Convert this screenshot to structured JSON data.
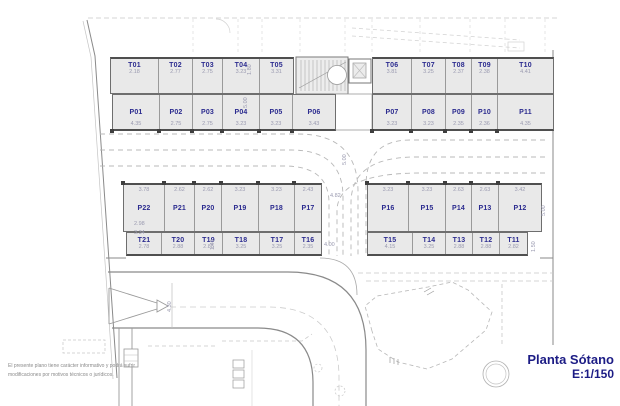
{
  "title_block": {
    "title": "Planta Sótano",
    "scale": "E:1/150"
  },
  "disclaimer": {
    "line1": "El presente plano tiene carácter informativo y podrá sufrir",
    "line2": "modificaciones por motivos técnicos o jurídicos."
  },
  "colors": {
    "label_blue": "#2b2b8f",
    "title_navy": "#1c1c85",
    "stall_fill": "#e9e9e9",
    "wall_gray": "#4f4f4f",
    "dim_gray": "#9a9ab0"
  },
  "plan": {
    "groups": [
      {
        "id": "storage-top-left",
        "type": "storage",
        "style": "t-top",
        "x": 110,
        "y": 57,
        "h": 37,
        "sq": "",
        "stalls": [
          {
            "label": "T01",
            "dim": "2.18",
            "w": 47
          },
          {
            "label": "T02",
            "dim": "2.77",
            "w": 34
          },
          {
            "label": "T03",
            "dim": "2.75",
            "w": 30
          },
          {
            "label": "T04",
            "dim": "3.23",
            "w": 37
          },
          {
            "label": "T05",
            "dim": "3.31",
            "w": 34
          }
        ]
      },
      {
        "id": "storage-top-right",
        "type": "storage",
        "style": "t-top",
        "x": 372,
        "y": 57,
        "h": 37,
        "sq": "",
        "stalls": [
          {
            "label": "T06",
            "dim": "3.81",
            "w": 38
          },
          {
            "label": "T07",
            "dim": "3.25",
            "w": 34
          },
          {
            "label": "T08",
            "dim": "2.37",
            "w": 26
          },
          {
            "label": "T09",
            "dim": "2.38",
            "w": 26
          },
          {
            "label": "T10",
            "dim": "4.41",
            "w": 56
          }
        ]
      },
      {
        "id": "parking-top-left",
        "type": "parking",
        "style": "p-mid",
        "x": 112,
        "y": 94,
        "h": 37,
        "sq": "bottom",
        "stalls": [
          {
            "label": "P01",
            "dim": "4.35",
            "w": 46
          },
          {
            "label": "P02",
            "dim": "2.75",
            "w": 33
          },
          {
            "label": "P03",
            "dim": "2.75",
            "w": 30
          },
          {
            "label": "P04",
            "dim": "3.23",
            "w": 37
          },
          {
            "label": "P05",
            "dim": "3.23",
            "w": 33
          },
          {
            "label": "P06",
            "dim": "3.43",
            "w": 43
          }
        ]
      },
      {
        "id": "parking-top-right",
        "type": "parking",
        "style": "p-mid",
        "x": 372,
        "y": 94,
        "h": 37,
        "sq": "bottom",
        "stalls": [
          {
            "label": "P07",
            "dim": "3.23",
            "w": 38
          },
          {
            "label": "P08",
            "dim": "3.23",
            "w": 34
          },
          {
            "label": "P09",
            "dim": "2.35",
            "w": 26
          },
          {
            "label": "P10",
            "dim": "2.36",
            "w": 26
          },
          {
            "label": "P11",
            "dim": "4.35",
            "w": 56
          }
        ]
      },
      {
        "id": "parking-mid-left",
        "type": "parking",
        "style": "p-dimtop",
        "x": 123,
        "y": 183,
        "h": 49,
        "sq": "top",
        "stalls": [
          {
            "label": "P22",
            "dim": "3.78",
            "w": 40
          },
          {
            "label": "P21",
            "dim": "2.62",
            "w": 30
          },
          {
            "label": "P20",
            "dim": "2.62",
            "w": 27
          },
          {
            "label": "P19",
            "dim": "3.23",
            "w": 37
          },
          {
            "label": "P18",
            "dim": "3.23",
            "w": 36
          },
          {
            "label": "P17",
            "dim": "2.43",
            "w": 27
          }
        ]
      },
      {
        "id": "parking-mid-right",
        "type": "parking",
        "style": "p-dimtop",
        "x": 367,
        "y": 183,
        "h": 49,
        "sq": "top",
        "stalls": [
          {
            "label": "P16",
            "dim": "3.23",
            "w": 40
          },
          {
            "label": "P15",
            "dim": "3.23",
            "w": 37
          },
          {
            "label": "P14",
            "dim": "2.63",
            "w": 26
          },
          {
            "label": "P13",
            "dim": "2.63",
            "w": 27
          },
          {
            "label": "P12",
            "dim": "3.42",
            "w": 43
          }
        ]
      },
      {
        "id": "storage-bottom-left",
        "type": "storage",
        "style": "t-mid",
        "x": 126,
        "y": 232,
        "h": 24,
        "sq": "",
        "stalls": [
          {
            "label": "T21",
            "dim": "2.78",
            "w": 34
          },
          {
            "label": "T20",
            "dim": "2.88",
            "w": 33
          },
          {
            "label": "T19",
            "dim": "2.88",
            "w": 28
          },
          {
            "label": "T18",
            "dim": "3.25",
            "w": 37
          },
          {
            "label": "T17",
            "dim": "3.25",
            "w": 35
          },
          {
            "label": "T16",
            "dim": "2.35",
            "w": 27
          }
        ]
      },
      {
        "id": "storage-bottom-right",
        "type": "storage",
        "style": "t-mid",
        "x": 367,
        "y": 232,
        "h": 24,
        "sq": "",
        "stalls": [
          {
            "label": "T15",
            "dim": "4.15",
            "w": 44
          },
          {
            "label": "T14",
            "dim": "3.25",
            "w": 33
          },
          {
            "label": "T13",
            "dim": "2.88",
            "w": 27
          },
          {
            "label": "T12",
            "dim": "2.88",
            "w": 27
          },
          {
            "label": "T11",
            "dim": "2.82",
            "w": 28
          }
        ]
      }
    ],
    "annotations": [
      {
        "text": "1.80",
        "x": 247,
        "y": 75,
        "vertical": true
      },
      {
        "text": "5.00",
        "x": 243,
        "y": 108,
        "vertical": true
      },
      {
        "text": "5.00",
        "x": 342,
        "y": 165,
        "vertical": true
      },
      {
        "text": "4.82",
        "x": 330,
        "y": 193,
        "vertical": false
      },
      {
        "text": "4.00",
        "x": 324,
        "y": 242,
        "vertical": false
      },
      {
        "text": "2.98",
        "x": 134,
        "y": 221,
        "vertical": false
      },
      {
        "text": "3.34",
        "x": 134,
        "y": 230,
        "vertical": false
      },
      {
        "text": "1.40",
        "x": 210,
        "y": 250,
        "vertical": true
      },
      {
        "text": "5.00",
        "x": 541,
        "y": 216,
        "vertical": true
      },
      {
        "text": "1.50",
        "x": 531,
        "y": 252,
        "vertical": true
      },
      {
        "text": "4.30",
        "x": 167,
        "y": 312,
        "vertical": true
      }
    ]
  }
}
